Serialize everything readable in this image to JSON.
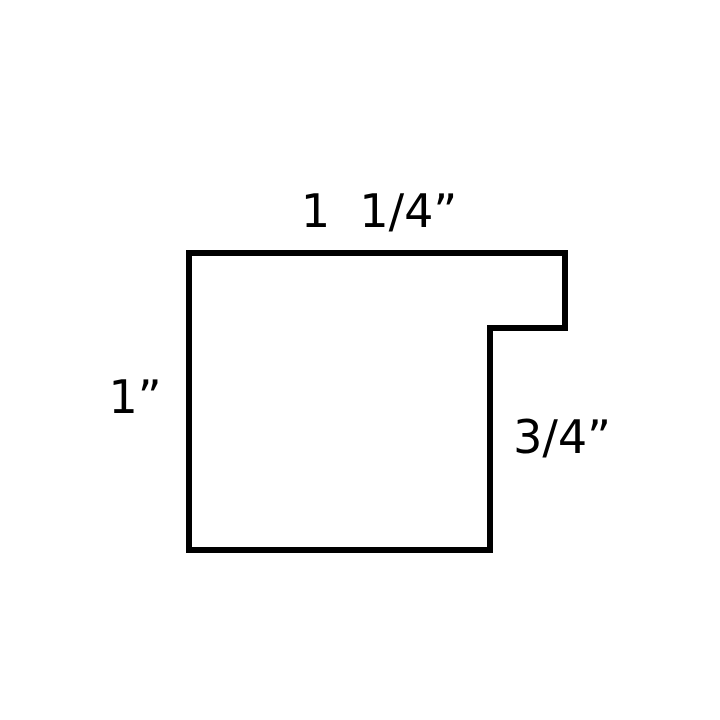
{
  "diagram": {
    "dimensions": {
      "top": "1  1/4”",
      "left": "1”",
      "right": "3/4”"
    }
  },
  "colors": {
    "background": "#ffffff",
    "line": "#000000",
    "text": "#000000"
  }
}
